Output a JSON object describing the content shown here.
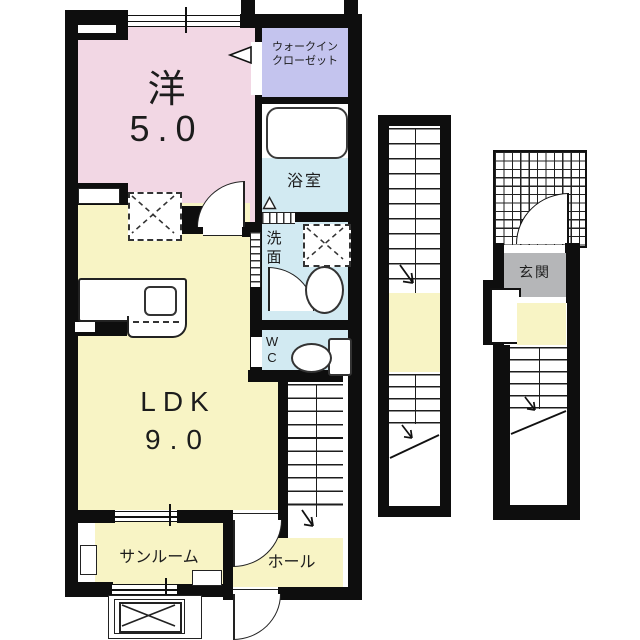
{
  "floorplan": {
    "rooms": {
      "western": {
        "label": "洋",
        "size": "5.0"
      },
      "ldk": {
        "label": "LDK",
        "size": "9.0"
      },
      "wic": {
        "label_line1": "ウォークイン",
        "label_line2": "クローゼット"
      },
      "bath": {
        "label": "浴室"
      },
      "washroom": {
        "label_char1": "洗",
        "label_char2": "面"
      },
      "wc": {
        "label_char1": "W",
        "label_char2": "C"
      },
      "sunroom": {
        "label": "サンルーム"
      },
      "hall": {
        "label": "ホール"
      },
      "entrance": {
        "label": "玄関"
      }
    },
    "colors": {
      "wall": "#0e0e0e",
      "western_room_fill": "#f2d7e4",
      "ldk_fill": "#f8f4c5",
      "water_area_fill": "#d2eaf2",
      "closet_fill": "#c4c4ee",
      "entrance_floor_fill": "#b5b6b8",
      "landing_fill": "#f8f4c5"
    }
  }
}
